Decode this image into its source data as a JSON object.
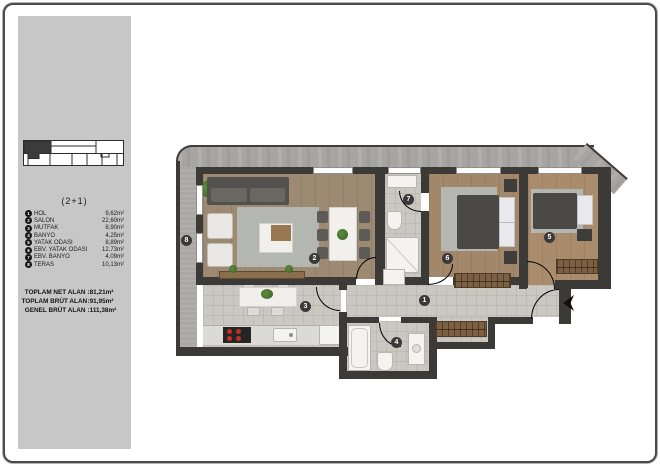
{
  "sidebar": {
    "plan_type": "(2+1)",
    "legend": [
      {
        "num": "1",
        "name": "HOL",
        "area": "9,62m²"
      },
      {
        "num": "2",
        "name": "SALON",
        "area": "22,60m²"
      },
      {
        "num": "3",
        "name": "MUTFAK",
        "area": "8,90m²"
      },
      {
        "num": "4",
        "name": "BANYO",
        "area": "4,25m²"
      },
      {
        "num": "5",
        "name": "YATAK ODASI",
        "area": "8,89m²"
      },
      {
        "num": "6",
        "name": "EBV. YATAK ODASI",
        "area": "12,73m²"
      },
      {
        "num": "7",
        "name": "EBV. BANYO",
        "area": "4,09m²"
      },
      {
        "num": "8",
        "name": "TERAS",
        "area": "10,13m²"
      }
    ],
    "totals": [
      {
        "label": "TOPLAM NET ALAN",
        "value": ":81,21m²"
      },
      {
        "label": "TOPLAM BRÜT ALAN",
        "value": ":91,95m²"
      },
      {
        "label": "GENEL BRÜT ALAN",
        "value": ":111,38m²"
      }
    ]
  },
  "plan": {
    "markers": [
      "1",
      "2",
      "3",
      "4",
      "5",
      "6",
      "7",
      "8"
    ]
  },
  "colors": {
    "sidebar_bg": "#c6c7c6",
    "wall": "#3c3a37",
    "exterior_wall": "#a7a5a1",
    "wood_floor": "#9d8a72",
    "tile_floor": "#cbc8c2",
    "legend_badge": "#141414"
  }
}
